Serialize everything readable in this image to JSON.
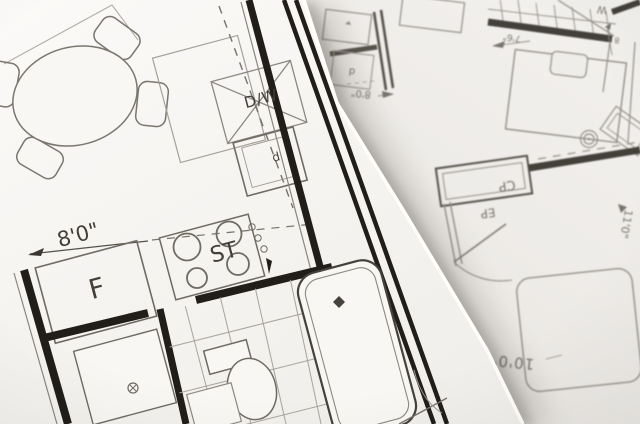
{
  "scene": {
    "type": "architectural-floor-plans-photo",
    "sheets": 2
  },
  "colors": {
    "paper_top": "#f8f7f3",
    "paper_bottom": "#efede9",
    "wall_ink": "#211e1a",
    "line_ink": "#6f6b63",
    "faint_ink": "#a5a199",
    "text_ink": "#433f37",
    "right_ink": "#8a867f"
  },
  "left_plan": {
    "labels": {
      "dishwasher": "D/W",
      "sink_box": "d",
      "dim_width": "8'0\"",
      "fridge": "F",
      "stove": "ST"
    }
  },
  "right_plan": {
    "labels": {
      "washer": "W",
      "dim_a": "7'6\"",
      "dim_b": "8",
      "dim_c": "8'0\"",
      "door_glyph": "d",
      "closet": "CP",
      "panel": "EP",
      "dim_d": "10'0\"",
      "dim_e": "11'0\""
    }
  }
}
